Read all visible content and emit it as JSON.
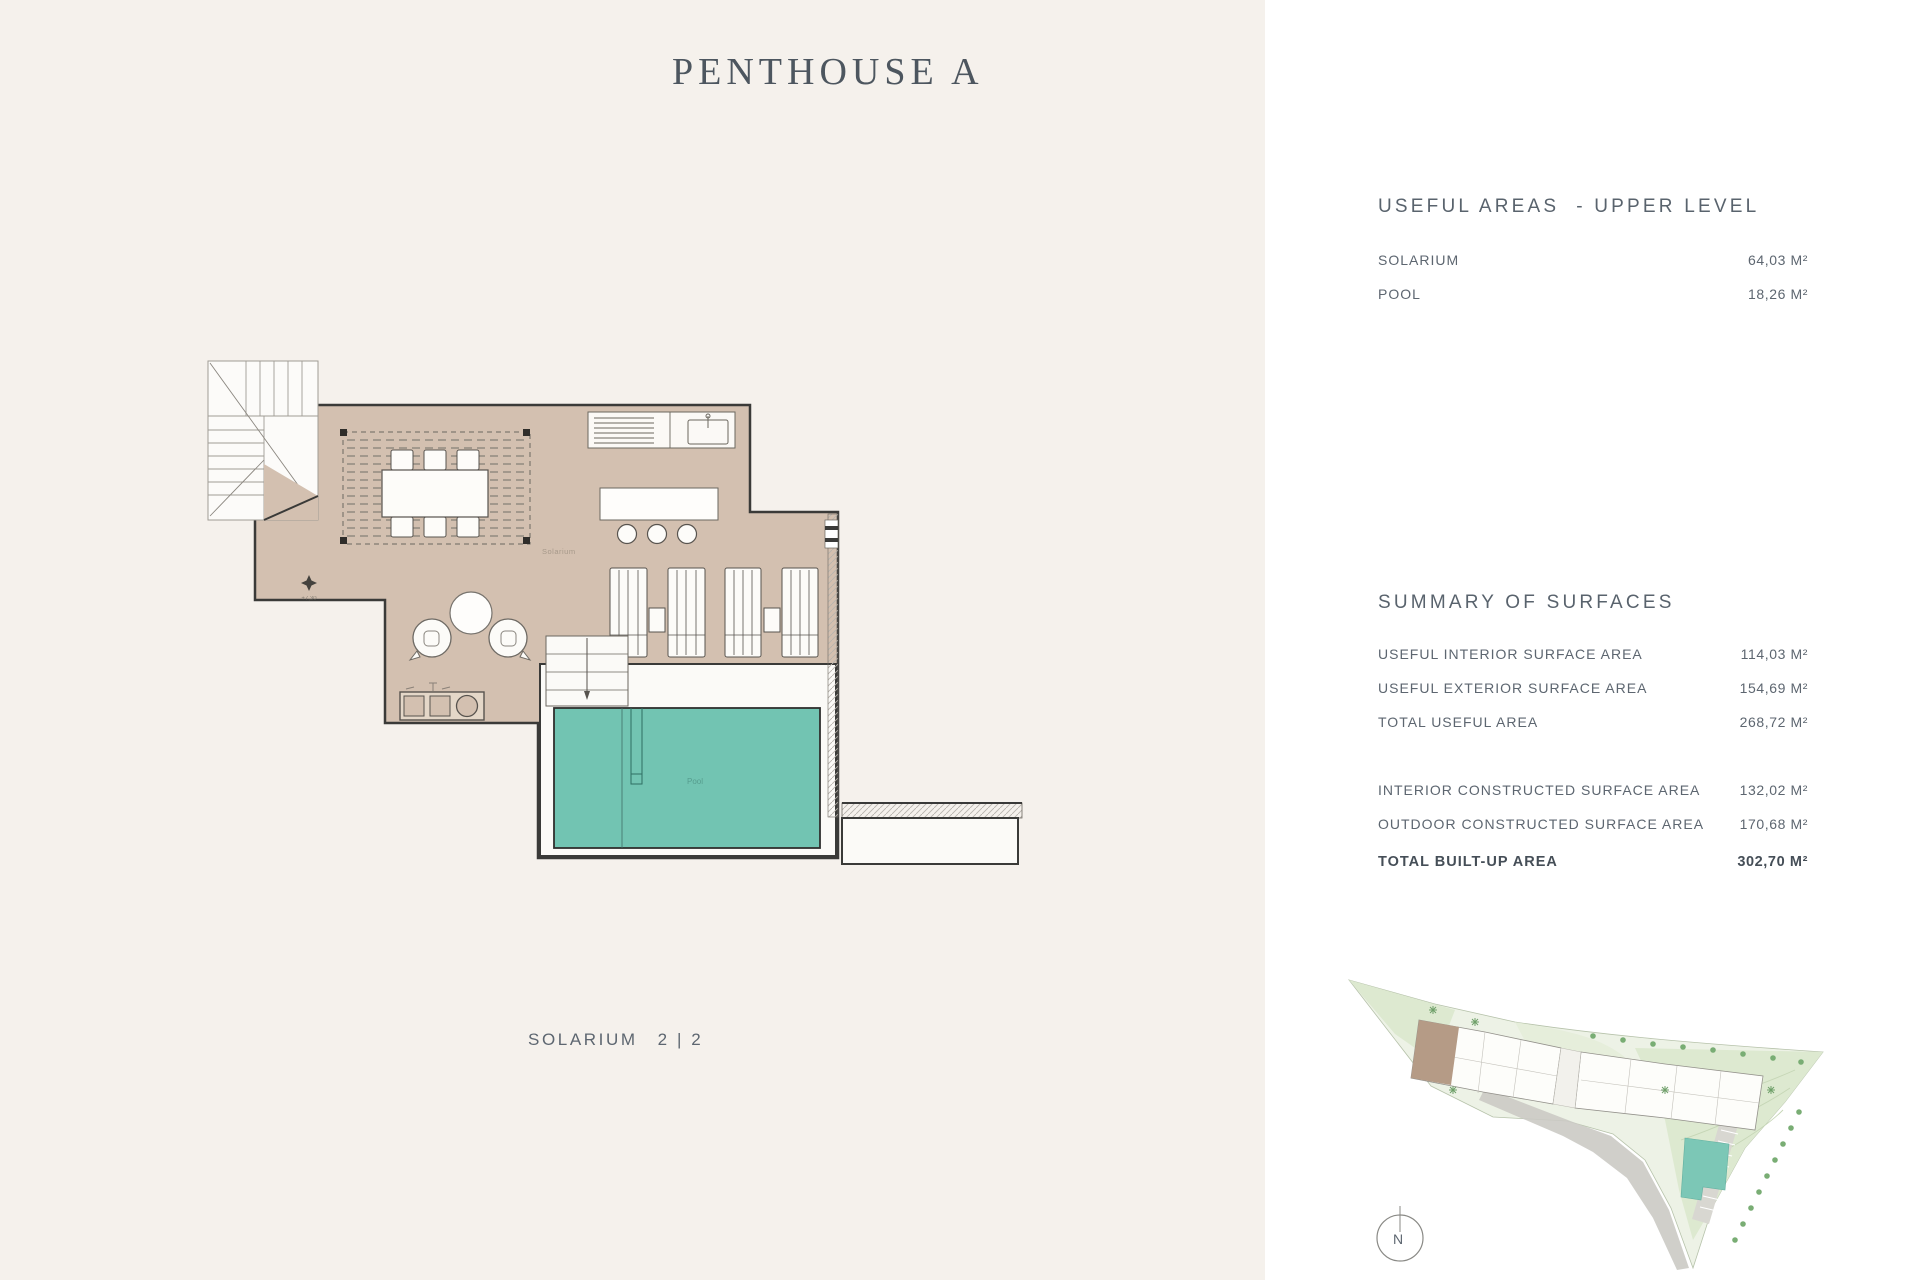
{
  "header": {
    "title": "PENTHOUSE A"
  },
  "floor_plan": {
    "name_label": "SOLARIUM",
    "page_indicator": "2 | 2",
    "room_label": "Solarium",
    "pool_label": "Pool",
    "elevation_label": "+7,30",
    "colors": {
      "panel_bg": "#f5f1ec",
      "floor": "#d3c0b0",
      "pool": "#72c4b2",
      "wall": "#3a3a38"
    }
  },
  "useful_areas": {
    "title": "USEFUL AREAS  - UPPER LEVEL",
    "rows": [
      {
        "label": "SOLARIUM",
        "value": "64,03 M²"
      },
      {
        "label": "POOL",
        "value": "18,26 M²"
      }
    ]
  },
  "summary": {
    "title": "SUMMARY OF SURFACES",
    "rows": [
      {
        "label": "USEFUL INTERIOR SURFACE AREA",
        "value": "114,03 M²"
      },
      {
        "label": "USEFUL EXTERIOR SURFACE AREA",
        "value": "154,69 M²"
      },
      {
        "label": "TOTAL USEFUL AREA",
        "value": "268,72 M²"
      },
      {
        "label": "INTERIOR CONSTRUCTED SURFACE AREA",
        "value": "132,02 M²"
      },
      {
        "label": "OUTDOOR CONSTRUCTED SURFACE AREA",
        "value": "170,68 M²"
      }
    ],
    "total": {
      "label": "TOTAL BUILT-UP AREA",
      "value": "302,70 M²"
    }
  },
  "site_plan": {
    "north_label": "N"
  }
}
